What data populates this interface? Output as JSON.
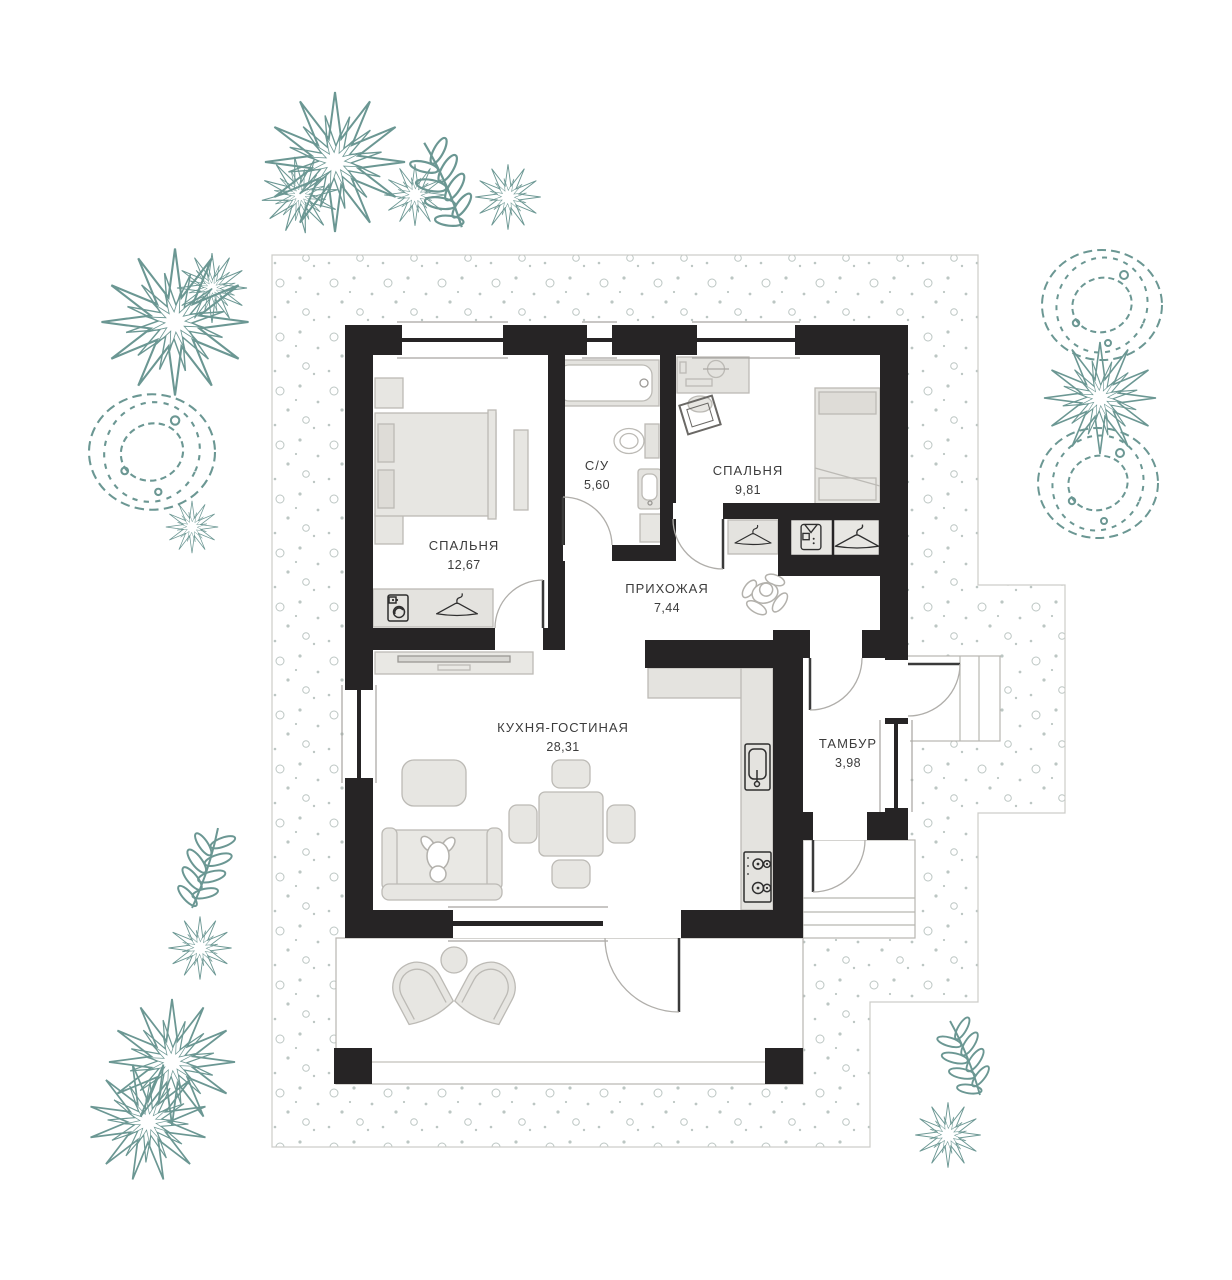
{
  "canvas": {
    "width": 1232,
    "height": 1280,
    "background": "#ffffff"
  },
  "rooms": [
    {
      "key": "bedroom-1",
      "name": "СПАЛЬНЯ",
      "area": "12,67"
    },
    {
      "key": "bathroom",
      "name": "С/У",
      "area": "5,60"
    },
    {
      "key": "bedroom-2",
      "name": "СПАЛЬНЯ",
      "area": "9,81"
    },
    {
      "key": "hallway",
      "name": "ПРИХОЖАЯ",
      "area": "7,44"
    },
    {
      "key": "kitchen-living",
      "name": "КУХНЯ-ГОСТИНАЯ",
      "area": "28,31"
    },
    {
      "key": "vestibule",
      "name": "ТАМБУР",
      "area": "3,98"
    }
  ],
  "colors": {
    "wall": "#262425",
    "furniture_fill": "#e7e6e2",
    "furniture_stroke": "#bcbab5",
    "counter_fill": "#e4e3df",
    "plant_stroke": "#6b9793",
    "ground_dots": "#bcc6c3",
    "ground_border": "#cdcdc9",
    "label_text": "#3c3c3c",
    "door_leaf": "#3a3a3a",
    "door_arc": "#b0aeaa"
  },
  "icons": {
    "wardrobe_bedroom_1": [
      "washer-icon",
      "hanger-icon"
    ],
    "hall_closet": [
      "shirt-icon",
      "hanger-icon"
    ],
    "wardrobe_bedroom_2": [
      "hanger-icon"
    ],
    "kitchen": [
      "sink-icon",
      "stove-icon"
    ],
    "bathroom": [
      "bathtub-icon",
      "toilet-icon",
      "sink-icon"
    ],
    "figures": [
      "person-figure-hallway",
      "person-figure-sofa"
    ],
    "plants": [
      "spiky-bush",
      "cloud-bush",
      "fern",
      "aster-flower"
    ]
  }
}
